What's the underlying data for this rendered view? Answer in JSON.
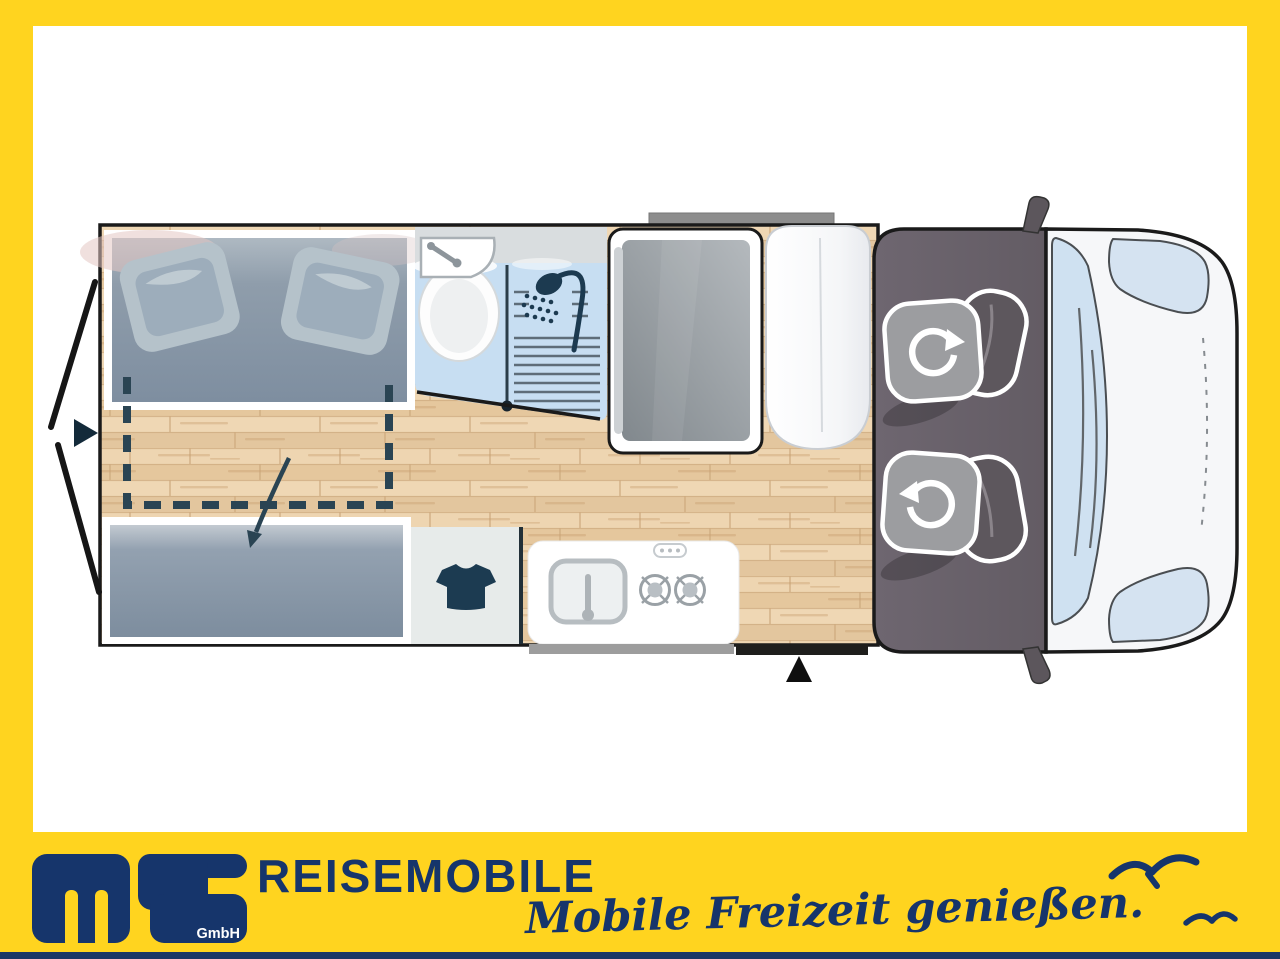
{
  "page": {
    "background_yellow": "#FFD41F",
    "panel_white": "#FFFFFF",
    "footer_strip_navy": "#1B3766"
  },
  "branding": {
    "company": "REISEMOBILE",
    "logo_text": "ms",
    "logo_sub": "GmbH",
    "slogan": "Mobile Freizeit genießen.",
    "navy": "#16356B",
    "yellow": "#FFD41F"
  },
  "floorplan": {
    "type": "campervan-top-view-floor-plan",
    "areas": [
      {
        "name": "rear-double-bed"
      },
      {
        "name": "convertible-lower-bed"
      },
      {
        "name": "bathroom-with-toilet-sink-shower"
      },
      {
        "name": "tall-cabinet"
      },
      {
        "name": "white-storage-unit"
      },
      {
        "name": "wardrobe"
      },
      {
        "name": "kitchen-block"
      },
      {
        "name": "driver-cab-with-swivel-seats"
      },
      {
        "name": "vehicle-front"
      }
    ],
    "icons": [
      "toilet-icon",
      "vanity-sink-icon",
      "shower-head-icon",
      "shower-partition-icon",
      "wardrobe-shirt-icon",
      "kitchen-sink-icon",
      "gas-burner-icon",
      "control-pill-icon",
      "swivel-seat-rotation-arrow-icon",
      "entry-door-triangle-icon",
      "rear-doors-open-arrow-icon",
      "bed-convert-arrow-icon",
      "side-mirror-icon",
      "seagull-icon"
    ],
    "colors": {
      "wood_floor": "#E9CDA7",
      "bed_gray": "#8494A5",
      "bath_blue": "#C7DEF2",
      "cab_gray": "#6A626B",
      "glass_blue": "#CFE1F1",
      "outline": "#1A1A1A",
      "dashed_teal": "#2A4453"
    }
  }
}
